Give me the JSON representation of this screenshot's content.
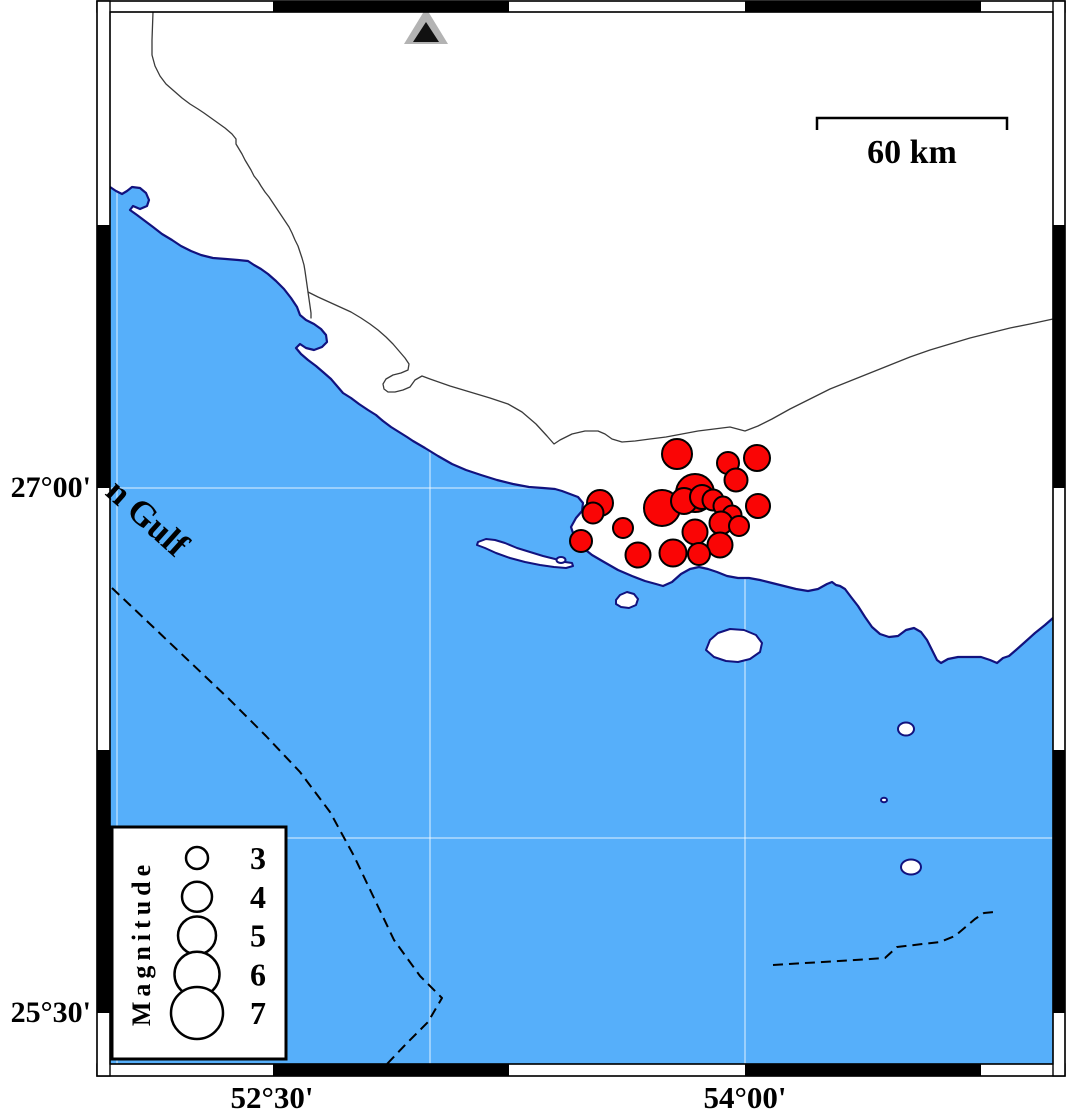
{
  "map": {
    "colors": {
      "sea": "#56affa",
      "coast_outline": "#12127e",
      "epicenter_fill": "#fa0505",
      "epicenter_stroke": "#000000",
      "gridline": "rgba(255,255,255,0.55)",
      "station_gray": "#b3b3b3"
    },
    "sea_label": "n Gulf",
    "station_marker": {
      "shape": "triangle",
      "x": 426,
      "y": 26
    },
    "epicenters": [
      {
        "x": 677,
        "y": 454,
        "r": 15
      },
      {
        "x": 757,
        "y": 458,
        "r": 13
      },
      {
        "x": 728,
        "y": 463,
        "r": 11
      },
      {
        "x": 736,
        "y": 480,
        "r": 11.5
      },
      {
        "x": 695,
        "y": 493,
        "r": 19
      },
      {
        "x": 662,
        "y": 508,
        "r": 18
      },
      {
        "x": 684,
        "y": 501,
        "r": 13
      },
      {
        "x": 702,
        "y": 497,
        "r": 12
      },
      {
        "x": 713,
        "y": 500,
        "r": 10.5
      },
      {
        "x": 723,
        "y": 506,
        "r": 9.5
      },
      {
        "x": 758,
        "y": 506,
        "r": 12
      },
      {
        "x": 732,
        "y": 515,
        "r": 9.5
      },
      {
        "x": 721,
        "y": 523,
        "r": 11.5
      },
      {
        "x": 739,
        "y": 526,
        "r": 10
      },
      {
        "x": 695,
        "y": 532,
        "r": 12.5
      },
      {
        "x": 720,
        "y": 545,
        "r": 12.5
      },
      {
        "x": 699,
        "y": 554,
        "r": 11
      },
      {
        "x": 673,
        "y": 553,
        "r": 13.5
      },
      {
        "x": 638,
        "y": 555,
        "r": 12.5
      },
      {
        "x": 600,
        "y": 503,
        "r": 13
      },
      {
        "x": 593,
        "y": 513,
        "r": 10.5
      },
      {
        "x": 623,
        "y": 528,
        "r": 10
      },
      {
        "x": 581,
        "y": 541,
        "r": 11
      }
    ]
  },
  "frame": {
    "lat_labels": [
      {
        "text": "27°00'",
        "y": 488
      },
      {
        "text": "25°30'",
        "y": 1013
      }
    ],
    "lon_labels": [
      {
        "text": "52°30'",
        "x": 272
      },
      {
        "text": "54°00'",
        "x": 745
      }
    ]
  },
  "scalebar": {
    "label": "60 km"
  },
  "legend": {
    "title": "Magnitude",
    "entries": [
      {
        "mag": "3",
        "r": 11
      },
      {
        "mag": "4",
        "r": 15
      },
      {
        "mag": "5",
        "r": 19
      },
      {
        "mag": "6",
        "r": 22.5
      },
      {
        "mag": "7",
        "r": 26
      }
    ]
  }
}
